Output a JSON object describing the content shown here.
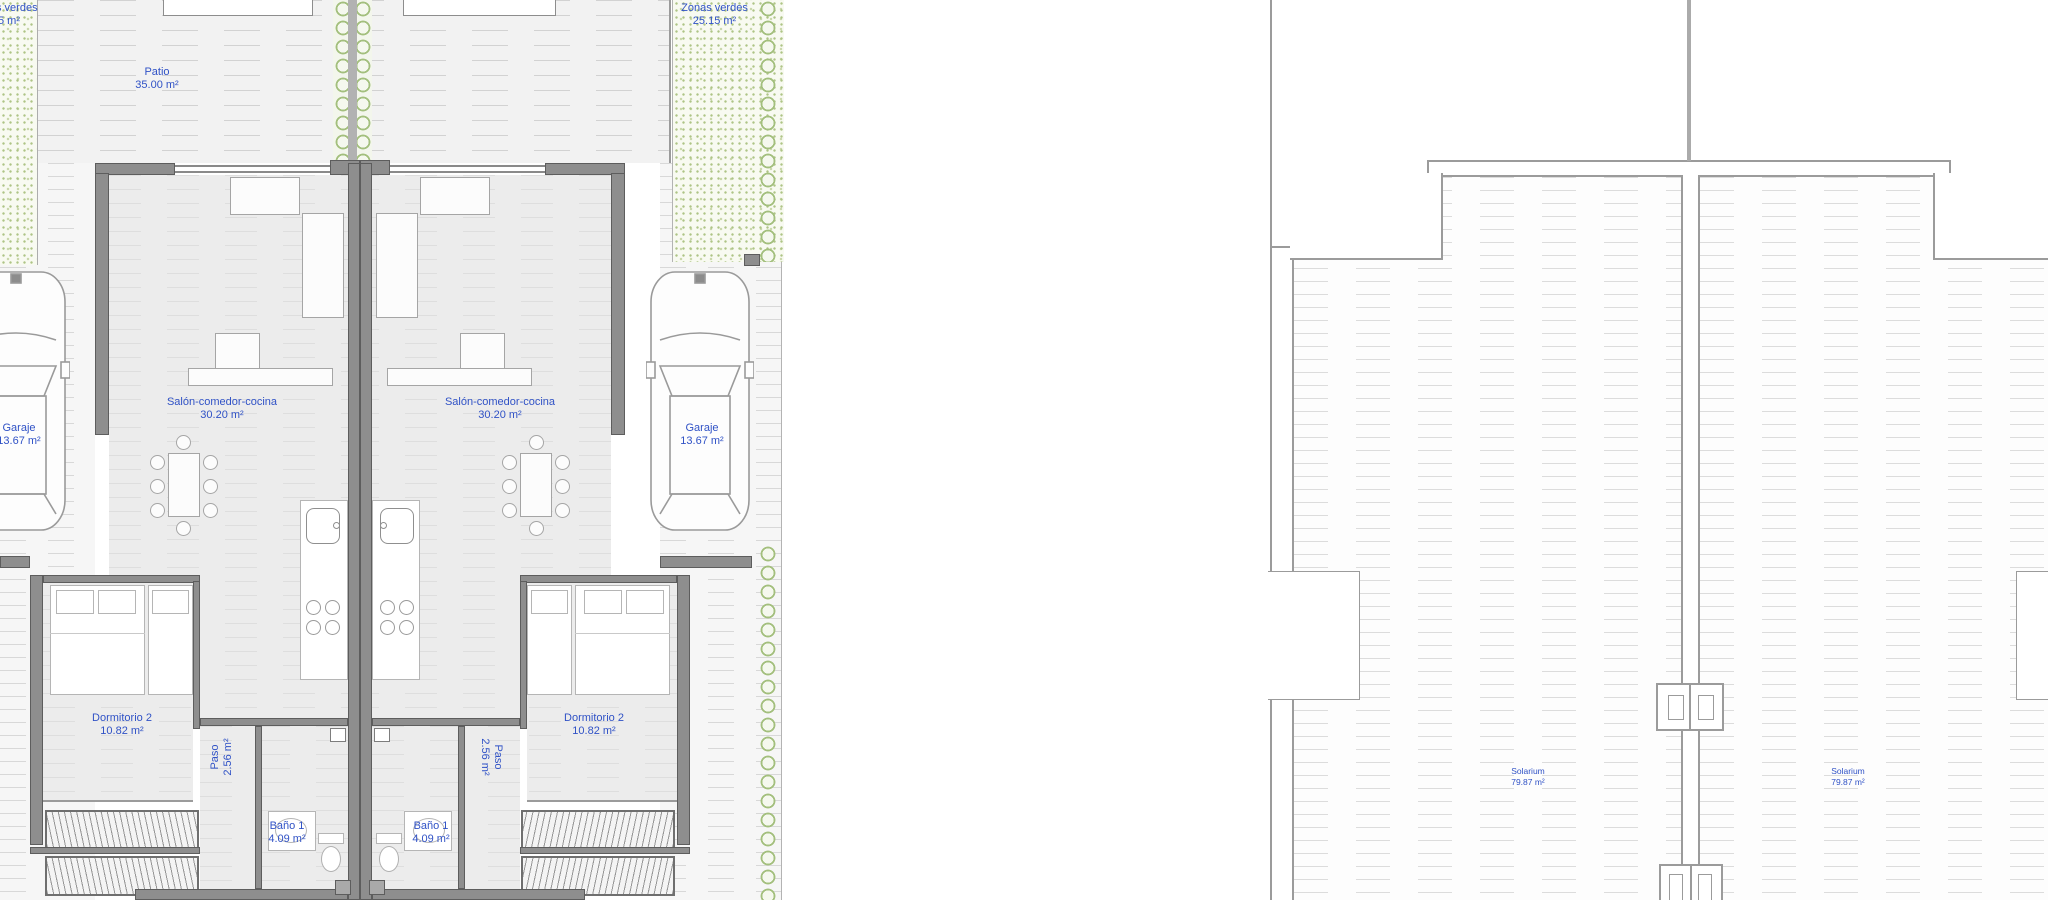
{
  "document_type": "architectural floor plan (ground floor and solarium roof plan of two mirrored semi-detached villas)",
  "colors": {
    "label_blue": "#3052c6",
    "wall_gray": "#8e8e8e",
    "hatch_line": "#d2d2d2",
    "vegetation_green": "#a3bf7d",
    "background": "#ffffff"
  },
  "left_plan": {
    "labels": {
      "partial": {
        "line1": "s verdes",
        "line2": "5 m²"
      },
      "patio": {
        "title": "Patio",
        "area": "35.00 m²"
      },
      "zonas": {
        "title": "Zonas verdes",
        "area": "25.15 m²"
      },
      "salon": {
        "title": "Salón-comedor-cocina",
        "area": "30.20 m²"
      },
      "garaje": {
        "title": "Garaje",
        "area": "13.67 m²"
      },
      "dormitorio": {
        "title": "Dormitorio 2",
        "area": "10.82 m²"
      },
      "paso": {
        "title": "Paso",
        "area": "2.56 m²"
      },
      "bano": {
        "title": "Baño 1",
        "area": "4.09 m²"
      }
    }
  },
  "right_plan": {
    "labels": {
      "solarium": {
        "title": "Solarium",
        "area": "79.87 m²"
      }
    }
  }
}
